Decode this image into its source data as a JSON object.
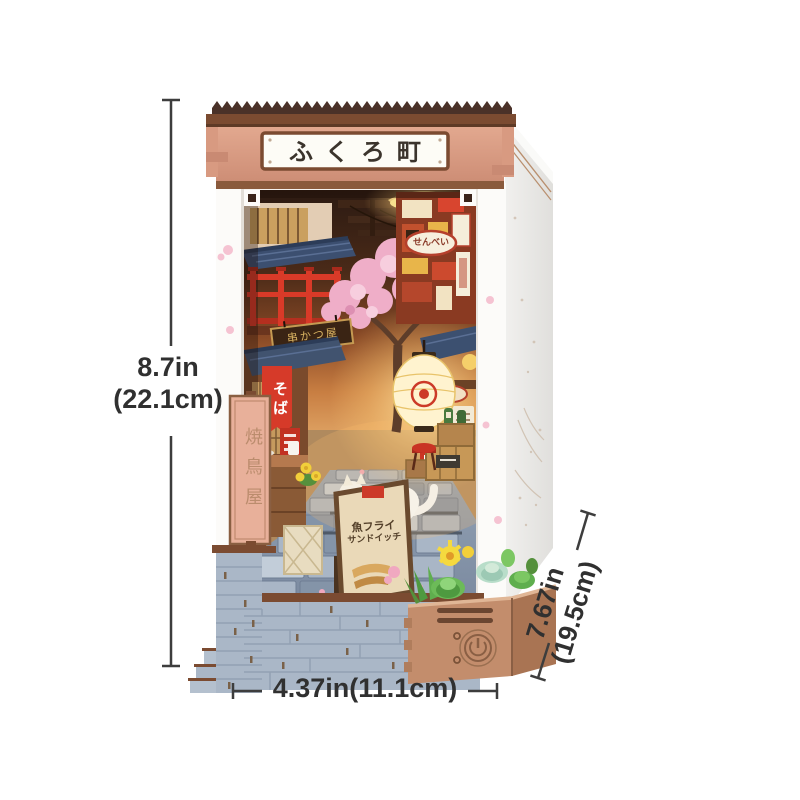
{
  "annotations": {
    "height": {
      "line1": "8.7in",
      "line2": "(22.1cm)"
    },
    "width": {
      "label": "4.37in(11.1cm)"
    },
    "depth": {
      "line1": "7.67in",
      "line2": "(19.5cm)"
    }
  },
  "model": {
    "marquee_sign": "ふくろ町",
    "pillar_sign": "焼鳥屋",
    "soba_banner": "そば",
    "senbei_sign": "せんべい",
    "hanging_board": "串かつ屋",
    "sandwich_board": {
      "line1": "魚フライ",
      "line2": "サンドイッチ"
    }
  },
  "icons": {
    "planter_power_button": "power-icon"
  },
  "colors": {
    "dimension_text": "#303030",
    "dimension_line": "#3d3d3d",
    "roof_crest": "#4a3128",
    "roof_eave": "#7b4b31",
    "facade_salmon": "#dca089",
    "sign_plate": "#fdfcf6",
    "accent_red": "#d93a28",
    "blue_roof": "#3c5070",
    "blossom_pink": "#efaec8",
    "lantern_glow": "#ffe9a8",
    "stone_brick": "#aab7c7",
    "planter_wood": "#c38d6c",
    "succulent_green": "#6cbb58"
  }
}
